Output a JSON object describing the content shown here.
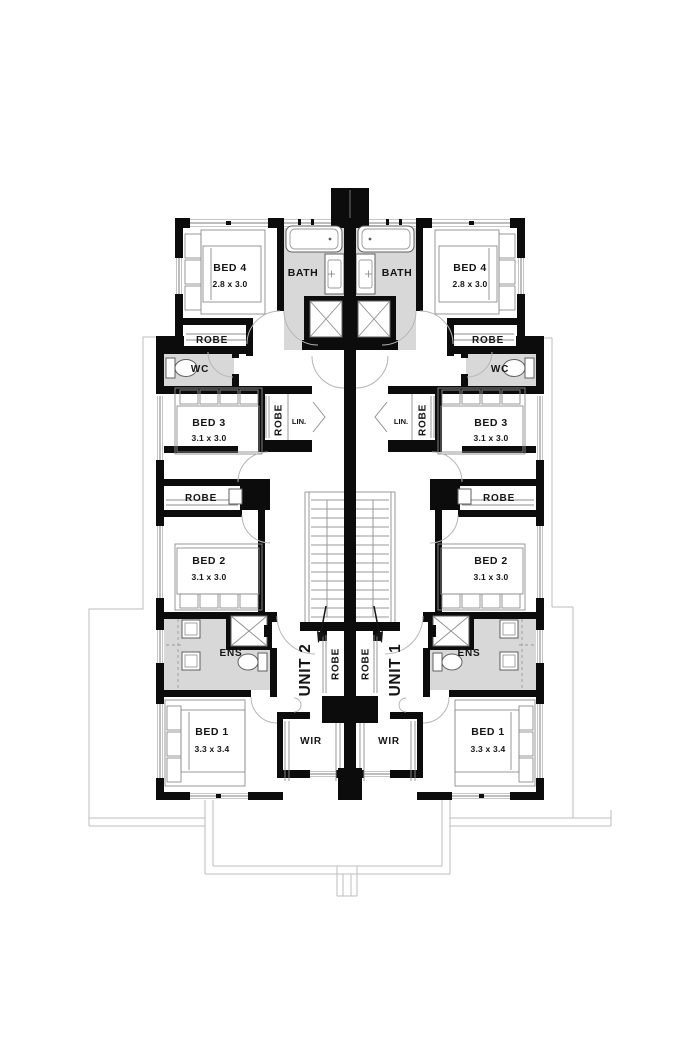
{
  "plan": {
    "type": "first-floor duplex floor plan",
    "units": [
      {
        "label": "UNIT 2",
        "rooms": {
          "bed4": {
            "name": "BED 4",
            "dims": "2.8 x 3.0"
          },
          "bath": {
            "name": "BATH"
          },
          "robe_bed4": {
            "name": "ROBE"
          },
          "wc": {
            "name": "WC"
          },
          "bed3": {
            "name": "BED 3",
            "dims": "3.1 x 3.0"
          },
          "robe_bed3": {
            "name": "ROBE"
          },
          "linen": {
            "name": "LIN."
          },
          "robe_bed2": {
            "name": "ROBE"
          },
          "bed2": {
            "name": "BED 2",
            "dims": "3.1 x 3.0"
          },
          "ens": {
            "name": "ENS"
          },
          "robe_hall": {
            "name": "ROBE"
          },
          "wir": {
            "name": "WIR"
          },
          "bed1": {
            "name": "BED 1",
            "dims": "3.3 x 3.4"
          }
        }
      },
      {
        "label": "UNIT 1",
        "rooms": {
          "bed4": {
            "name": "BED 4",
            "dims": "2.8 x 3.0"
          },
          "bath": {
            "name": "BATH"
          },
          "robe_bed4": {
            "name": "ROBE"
          },
          "wc": {
            "name": "WC"
          },
          "bed3": {
            "name": "BED 3",
            "dims": "3.1 x 3.0"
          },
          "robe_bed3": {
            "name": "ROBE"
          },
          "linen": {
            "name": "LIN."
          },
          "robe_bed2": {
            "name": "ROBE"
          },
          "bed2": {
            "name": "BED 2",
            "dims": "3.1 x 3.0"
          },
          "ens": {
            "name": "ENS"
          },
          "robe_hall": {
            "name": "ROBE"
          },
          "wir": {
            "name": "WIR"
          },
          "bed1": {
            "name": "BED 1",
            "dims": "3.3 x 3.4"
          }
        }
      }
    ]
  },
  "colors": {
    "wall": "#0c0c0c",
    "wet_area": "#d8d8d8",
    "fixture_line": "#5f5f5f",
    "ground_outline": "#bdbdbd",
    "text": "#151515",
    "background": "#ffffff"
  }
}
